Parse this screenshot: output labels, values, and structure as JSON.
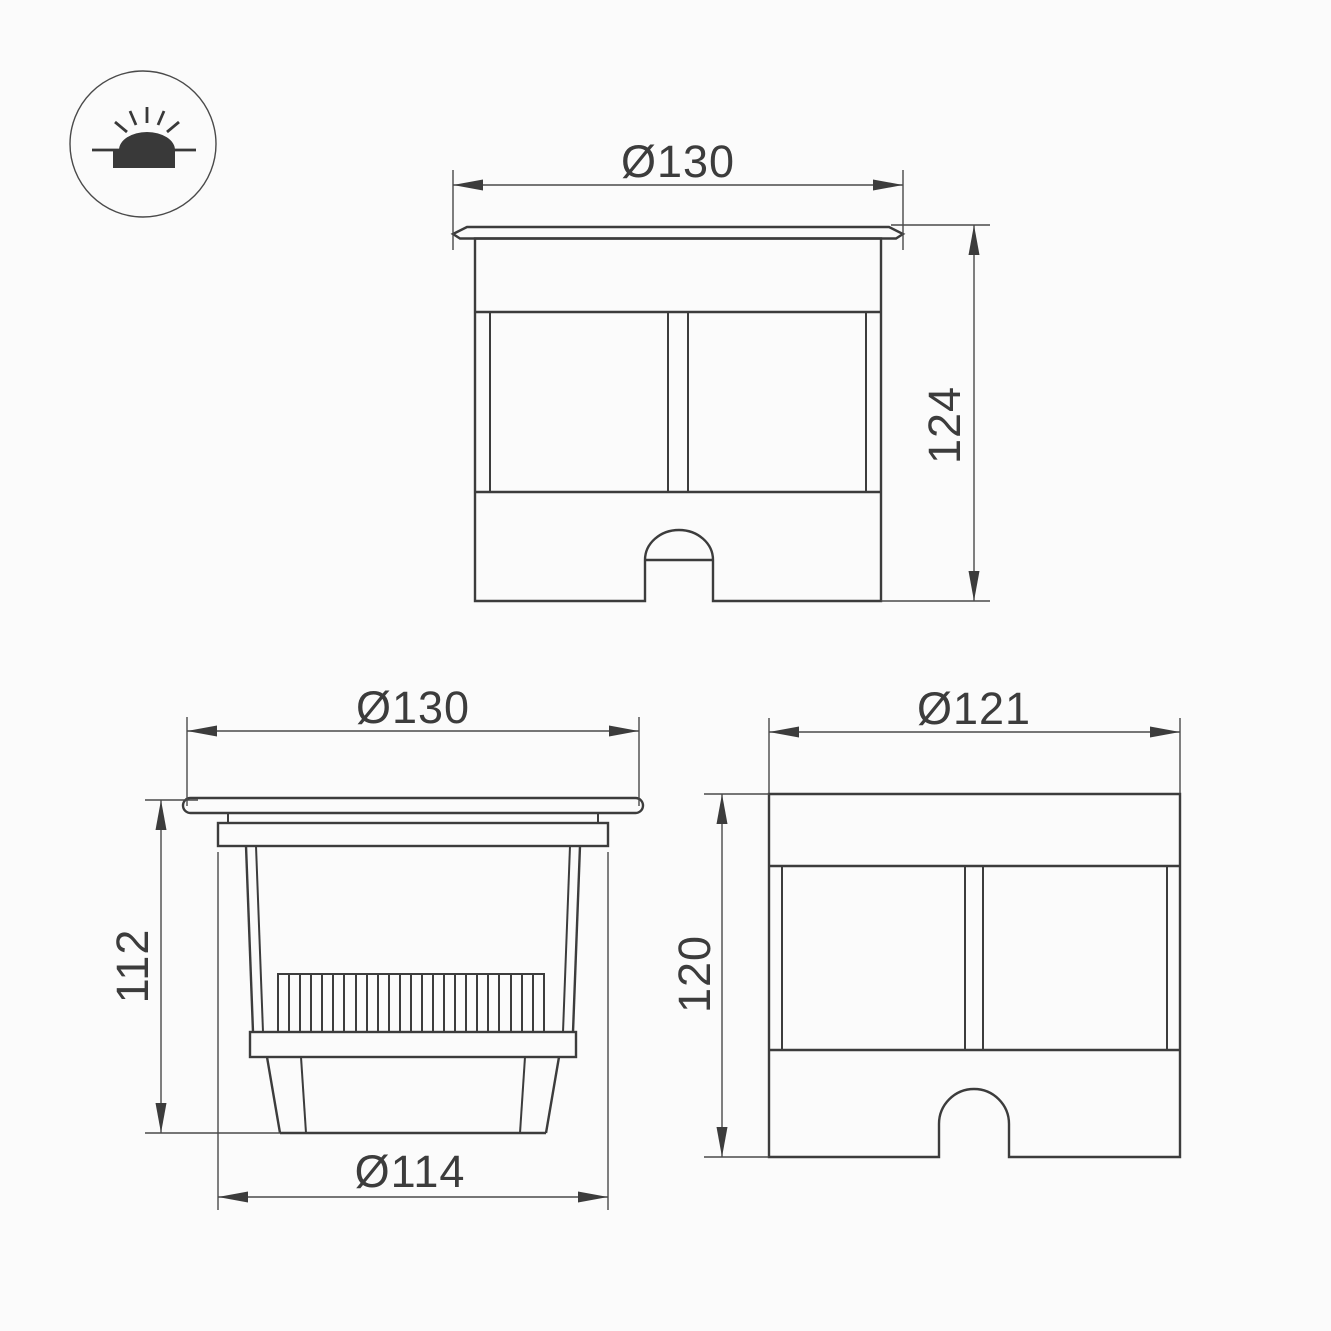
{
  "canvas": {
    "background": "#fbfbfb",
    "line_color": "#3c3c3c",
    "width": 1331,
    "height": 1331
  },
  "icon": {
    "name": "inground-light-icon"
  },
  "views": {
    "front": {
      "width_label": "Ø130",
      "height_label": "124"
    },
    "section": {
      "top_width_label": "Ø130",
      "height_label": "112",
      "bottom_width_label": "Ø114"
    },
    "body": {
      "width_label": "Ø121",
      "height_label": "120"
    }
  }
}
